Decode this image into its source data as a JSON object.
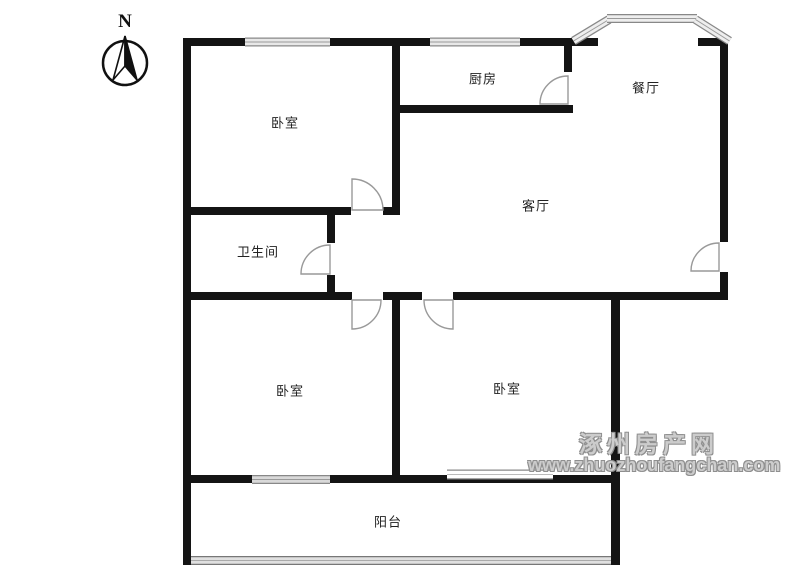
{
  "compass": {
    "north_label": "N"
  },
  "rooms": [
    {
      "name": "bedroom-top-left",
      "label": "卧室"
    },
    {
      "name": "kitchen",
      "label": "厨房"
    },
    {
      "name": "dining-room",
      "label": "餐厅"
    },
    {
      "name": "living-room",
      "label": "客厅"
    },
    {
      "name": "bathroom",
      "label": "卫生间"
    },
    {
      "name": "bedroom-bottom-left",
      "label": "卧室"
    },
    {
      "name": "bedroom-bottom-right",
      "label": "卧室"
    },
    {
      "name": "balcony",
      "label": "阳台"
    }
  ],
  "watermark": {
    "site_name": "涿州房产网",
    "site_url": "www.zhuozhoufangchan.com"
  },
  "colors": {
    "wall": "#141414",
    "window_fill": "#e8e8e8",
    "window_edge": "#888888",
    "door_arc": "#999999",
    "watermark_gray": "#cccccc",
    "label_text": "#222222"
  }
}
